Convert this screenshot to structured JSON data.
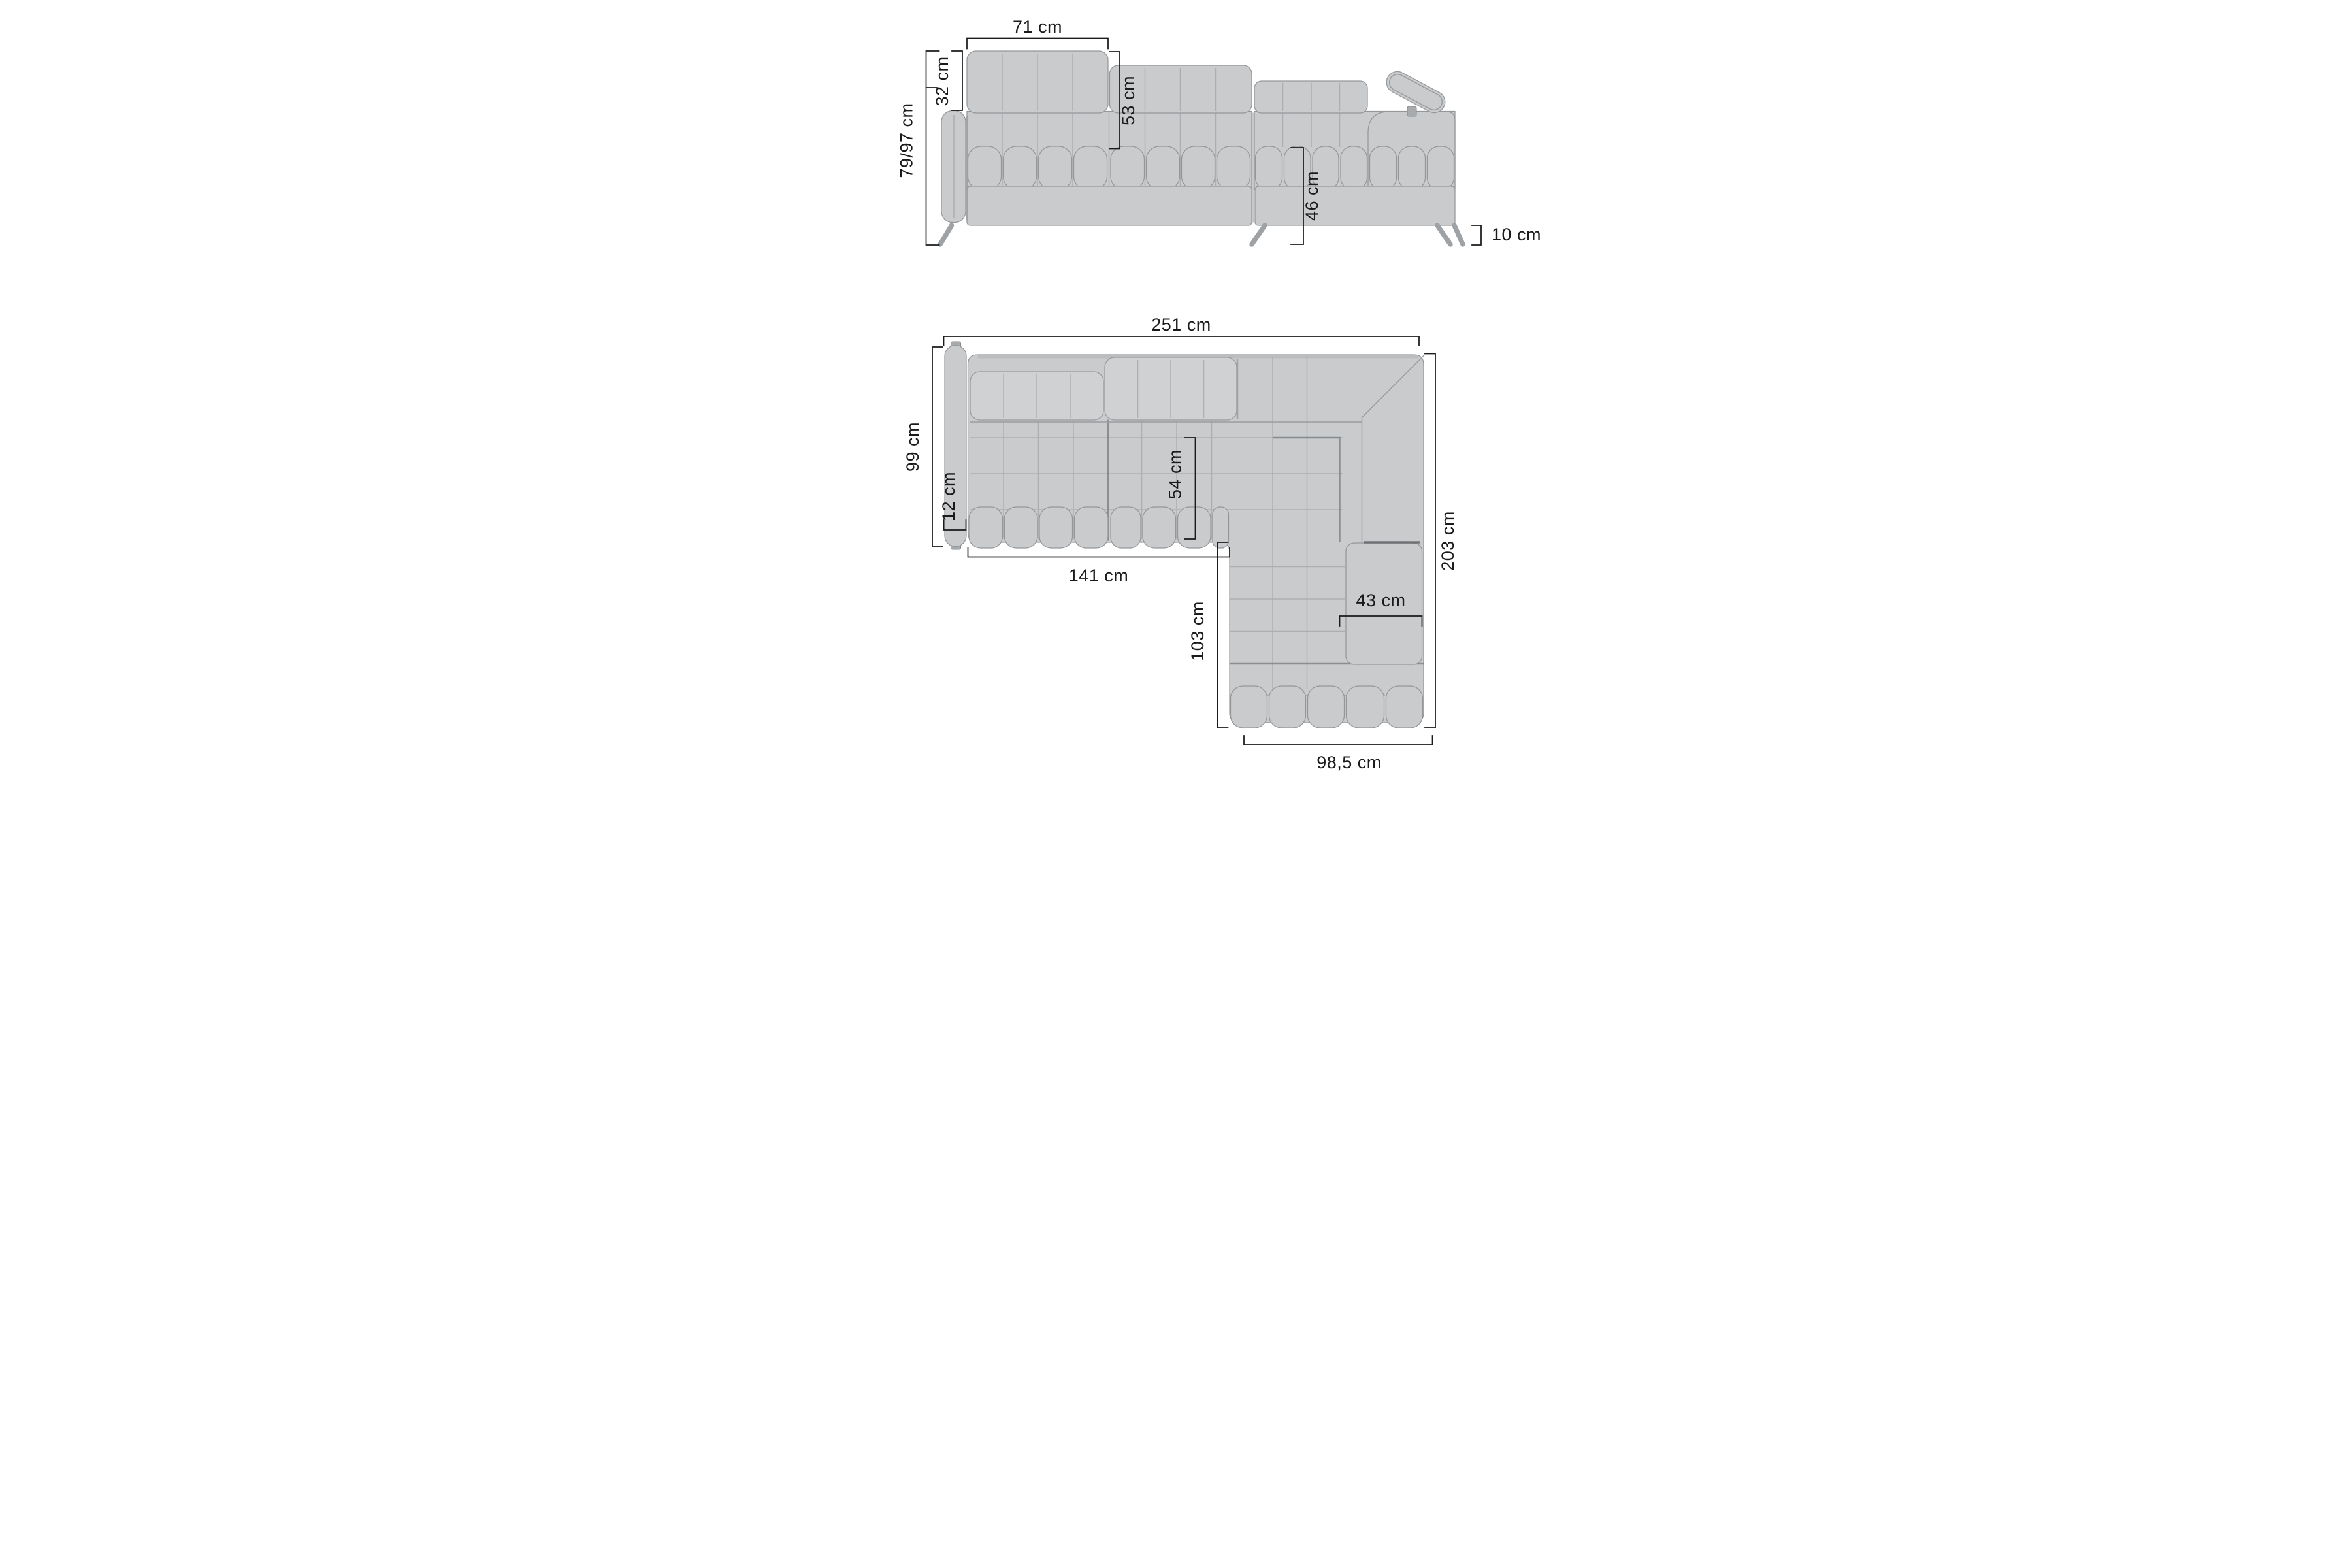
{
  "page": {
    "background": "#ffffff",
    "description": "Corner sofa technical dimensions diagram, front view and top view"
  },
  "styles": {
    "sofa_fill": "#c9cbcd",
    "sofa_fill_light": "#cfd1d3",
    "seam_color": "#9a9da0",
    "outline_color": "#94979a",
    "metal_color": "#a7abae",
    "dimension_color": "#1b1b1d"
  },
  "front_view": {
    "name": "Front view",
    "dimensions": {
      "headrest_width": "71 cm",
      "headrest_height": "32 cm",
      "height_range": "79/97 cm",
      "backrest_height": "53 cm",
      "seat_height": "46 cm",
      "leg_height": "10 cm"
    }
  },
  "top_view": {
    "name": "Top view",
    "dimensions": {
      "total_width": "251 cm",
      "side_depth": "99 cm",
      "armrest_width": "12 cm",
      "seat_depth": "54 cm",
      "seat_width": "141 cm",
      "chaise_length": "103 cm",
      "corner_cushion_width": "43 cm",
      "chaise_width": "98,5 cm",
      "total_depth": "203 cm"
    }
  }
}
